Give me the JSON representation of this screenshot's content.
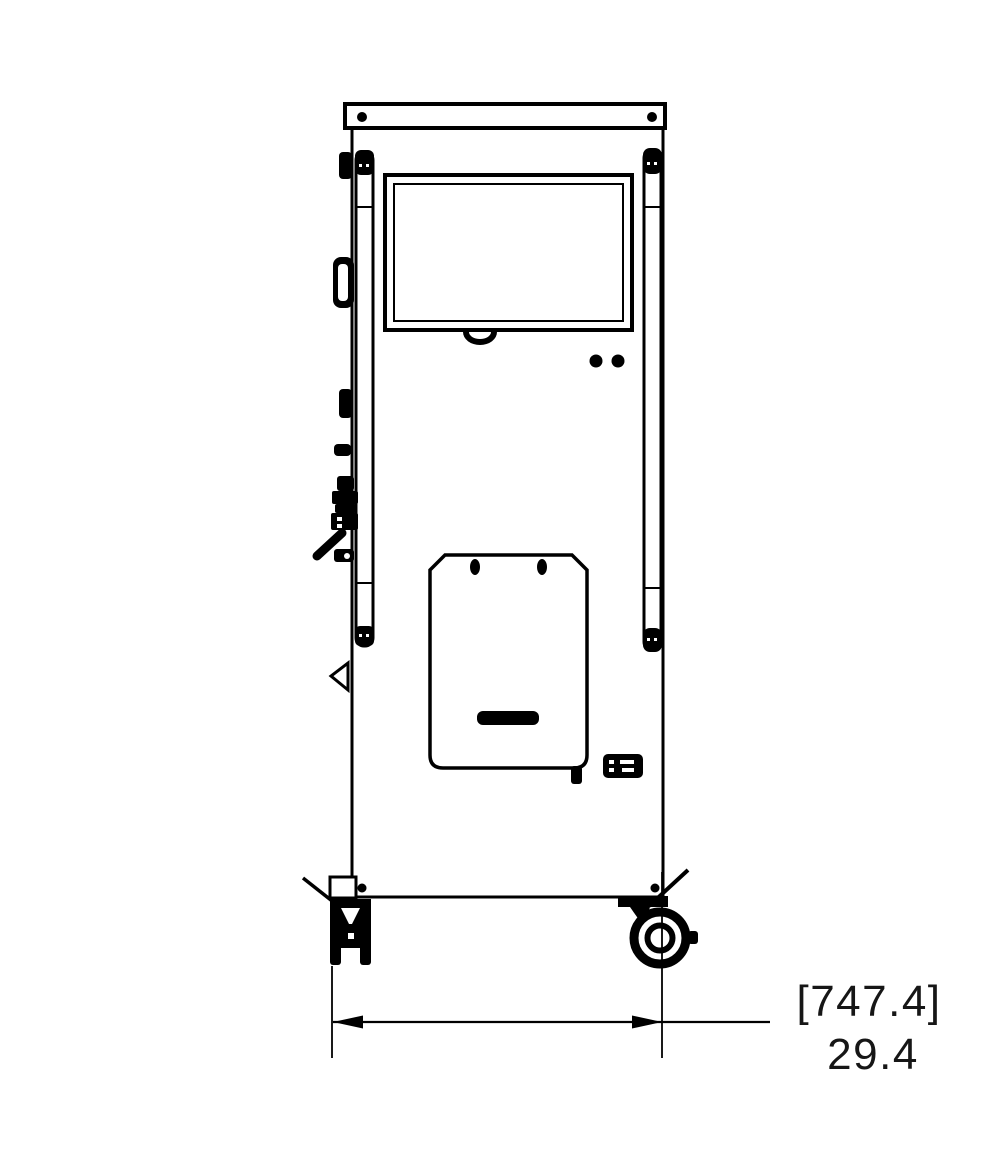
{
  "colors": {
    "line": "#000000",
    "background": "#ffffff"
  },
  "dimension_annotation": {
    "bracket_value": "[747.4]",
    "value": "29.4"
  }
}
